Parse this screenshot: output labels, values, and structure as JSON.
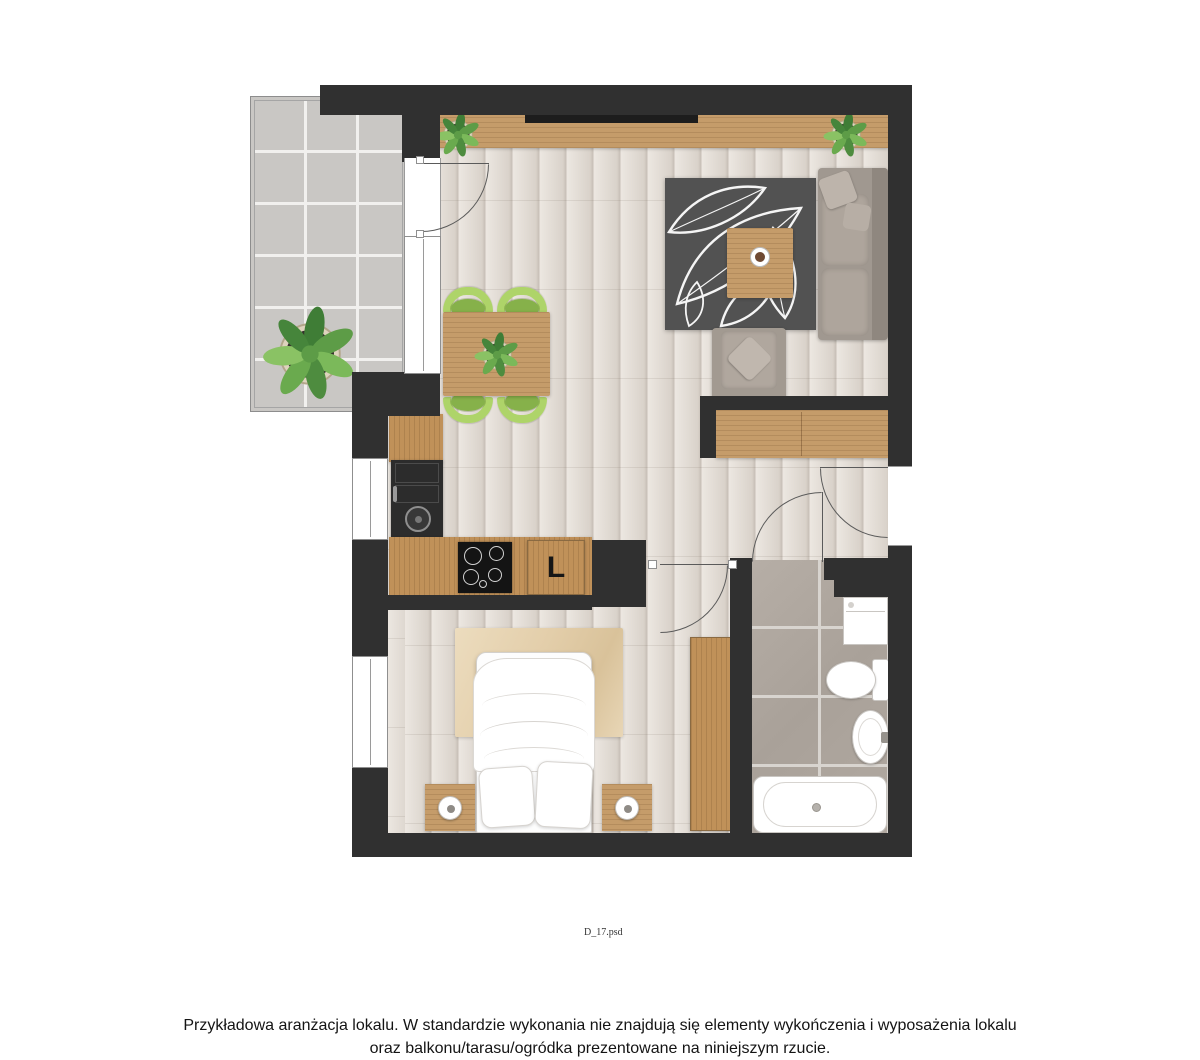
{
  "watermark": "D_17.psd",
  "caption": {
    "line1": "Przykładowa aranżacja lokalu. W standardzie wykonania nie znajdują się elementy wykończenia i wyposażenia lokalu",
    "line2": "oraz balkonu/tarasu/ogródka prezentowane na niniejszym rzucie."
  },
  "labels": {
    "fridge_letter": "L"
  },
  "palette": {
    "wall": "#303030",
    "wood_floor": "#e7e1da",
    "balcony_tile": "#c9c7c4",
    "bathroom_tile": "#aca49c",
    "furniture_wood": "#c59c6a",
    "sofa_gray": "#a29a91",
    "chair_green": "#aed469",
    "rug_dark": "#4f4f4f",
    "bedroom_rug_beige": "#e6d2b0",
    "plant_green": "#5d9c47"
  }
}
